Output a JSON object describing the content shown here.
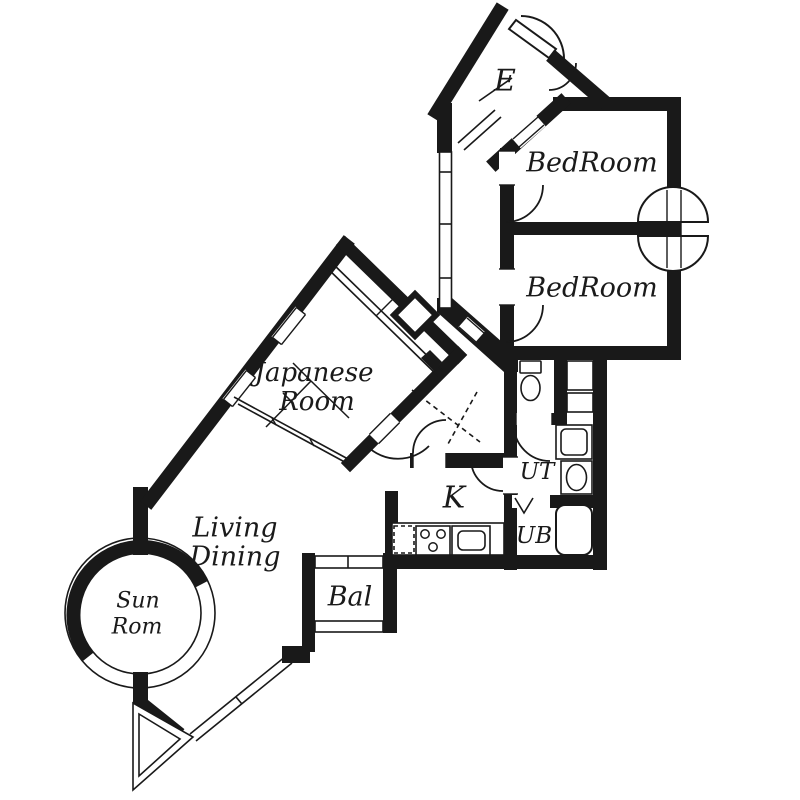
{
  "title": "Apartment floor plan",
  "colors": {
    "wall": "#191919",
    "background": "#ffffff"
  },
  "rooms": {
    "entrance": "E",
    "bedroom1": "BedRoom",
    "bedroom2": "BedRoom",
    "japanese_room": {
      "line1": "Japanese",
      "line2": "Room"
    },
    "living_dining": {
      "line1": "Living",
      "line2": "Dining"
    },
    "sun_room": {
      "line1": "Sun",
      "line2": "Rom"
    },
    "kitchen": "K",
    "utility": "UT",
    "unit_bath": "UB",
    "balcony": "Bal"
  }
}
